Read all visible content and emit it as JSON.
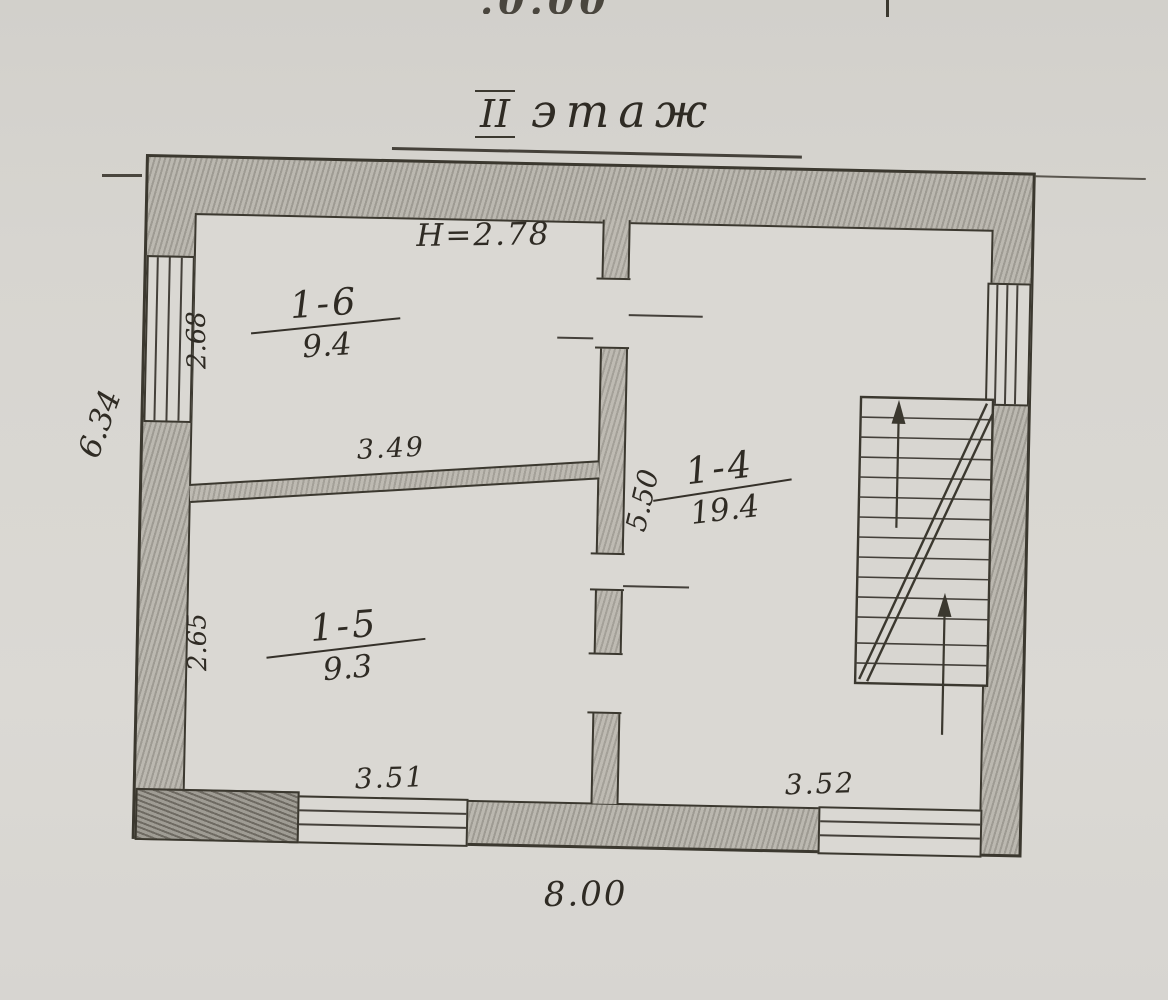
{
  "page": {
    "cropped_top_text": ".0.00"
  },
  "title": {
    "numeral": "II",
    "word": "этаж"
  },
  "plan": {
    "ceiling_height_note": "H=2.78",
    "rooms": [
      {
        "number": "1-6",
        "area": "9.4"
      },
      {
        "number": "1-5",
        "area": "9.3"
      },
      {
        "number": "1-4",
        "area": "19.4"
      }
    ],
    "dimensions": {
      "room_1_6_depth": "2.68",
      "room_1_6_width": "3.49",
      "room_1_5_depth": "2.65",
      "room_1_5_width": "3.51",
      "room_1_4_length": "5.50",
      "room_1_4_width": "3.52",
      "building_width": "8.00",
      "building_side": "6.34"
    }
  }
}
